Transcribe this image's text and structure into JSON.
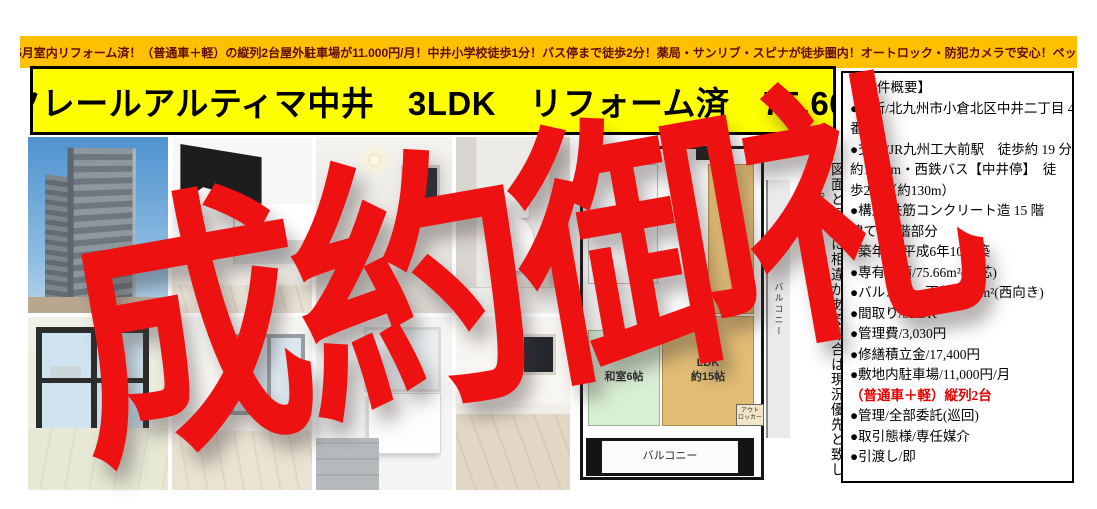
{
  "banner": {
    "text": "令和7年5月室内リフォーム済！（普通車＋軽）の縦列2台屋外駐車場が11.000円/月！中井小学校徒歩1分！バス停まで徒歩2分！薬局・サンリブ・スピナが徒歩圏内！オートロック・防犯カメラで安心！ペット不可！"
  },
  "title": {
    "text": "エクレールアルティマ中井　3LDK　リフォーム済　75.66 ㎡"
  },
  "overlay": {
    "text": "成約御礼"
  },
  "panel": {
    "lines": [
      "【物件概要】",
      "●住所/北九州市小倉北区中井二丁目 4",
      "番1",
      "●交通/JR九州工大前駅　徒歩約 19 分",
      "約1500m・西鉄バス【中井停】　徒",
      "歩2分（約130m）",
      "●構造/鉄筋コンクリート造 15 階",
      "建ての3階部分",
      "●築年月/平成6年10月築",
      "●専有面積/75.66m²(壁芯)",
      "●バルコニー面積/9.12m²(西向き)",
      "●間取り/3LDK",
      "●管理費/3,030円",
      "●修繕積立金/17,400円",
      "●敷地内駐車場/11,000円/月",
      "（普通車＋軽）縦列2台",
      "●管理/全部委託(巡回)",
      "●取引態様/専任媒介",
      "●引渡し/即"
    ]
  },
  "floor_plan": {
    "washitsu": "和室6帖",
    "ldk_line1": "LDK",
    "ldk_line2": "約15帖",
    "balcony_bottom": "バルコニー",
    "balcony_right": "バルコニー",
    "locker_line1": "アウト",
    "locker_line2": "ロッカー"
  },
  "disclaimer": {
    "text": "図面と現況に相違がある場合は現況優先と致します。"
  },
  "photos": {
    "row1": [
      "building-exterior",
      "kitchen",
      "hallway",
      "toilet"
    ],
    "row2": [
      "japanese-room-window",
      "western-room",
      "washroom-vanity",
      "wood-floor-room"
    ]
  },
  "colors": {
    "banner_bg": "#ffc000",
    "title_bg": "#ffff00",
    "overlay_red": "#ee1111",
    "panel_red": "#e00000",
    "plan_ldk": "#e3bd74",
    "plan_washitsu": "#d9efd4"
  }
}
